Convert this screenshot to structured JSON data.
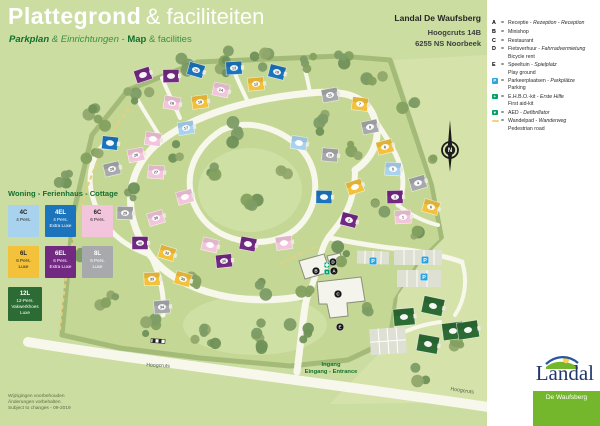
{
  "header": {
    "title_main": "Plattegrond",
    "title_rest": "& faciliteiten",
    "subtitle_segments": [
      {
        "text": "Parkplan ",
        "style": "bold-italic"
      },
      {
        "text": "& Einrichtungen",
        "style": "italic"
      },
      {
        "text": " - ",
        "style": "regular"
      },
      {
        "text": "Map",
        "style": "bold"
      },
      {
        "text": " & facilities",
        "style": "regular"
      }
    ]
  },
  "address": {
    "name": "Landal De Waufsberg",
    "line1": "Hoogcruts 14B",
    "line2": "6255 NS Noorbeek"
  },
  "legend": {
    "items": [
      {
        "icon": "A",
        "icon_type": "letter",
        "eq": "=",
        "main": "Receptie - ",
        "italic": "Rezeption - Reception",
        "sub": ""
      },
      {
        "icon": "B",
        "icon_type": "letter",
        "eq": "=",
        "main": "Minishop",
        "italic": "",
        "sub": ""
      },
      {
        "icon": "C",
        "icon_type": "letter",
        "eq": "=",
        "main": "Restaurant",
        "italic": "",
        "sub": ""
      },
      {
        "icon": "D",
        "icon_type": "letter",
        "eq": "=",
        "main": "Fietsverhuur - ",
        "italic": "Fahrradvermietung",
        "sub": "Bicycle rent"
      },
      {
        "icon": "E",
        "icon_type": "letter",
        "eq": "=",
        "main": "Speeltuin - ",
        "italic": "Spielplatz",
        "sub": "Play ground"
      },
      {
        "icon": "P",
        "icon_type": "parking",
        "eq": "=",
        "main": "Parkeerplaatsen - ",
        "italic": "Parkplätze",
        "sub": "Parking"
      },
      {
        "icon": "+",
        "icon_type": "firstaid",
        "eq": "=",
        "main": "E.H.B.O.-kit - ",
        "italic": "Erste Hilfe",
        "sub": "First aid-kit"
      },
      {
        "icon": "♥",
        "icon_type": "aed",
        "eq": "=",
        "main": "AED - ",
        "italic": "Defibrillator",
        "sub": ""
      },
      {
        "icon": "",
        "icon_type": "dash",
        "eq": "=",
        "main": "Wandelpad - ",
        "italic": "Wanderweg",
        "sub": "Pedestrian road"
      }
    ]
  },
  "cottage_legend": {
    "title": "Woning - Ferienhaus - Cottage",
    "types": [
      {
        "code": "4C",
        "color": "#a9d2ef",
        "text_color": "#222222",
        "lines": [
          "4 Pers."
        ]
      },
      {
        "code": "4EL",
        "color": "#1c75bc",
        "text_color": "#ffffff",
        "lines": [
          "4 Pers.",
          "Extra Luxe"
        ]
      },
      {
        "code": "6C",
        "color": "#f3c5dc",
        "text_color": "#222222",
        "lines": [
          "6 Pers."
        ]
      },
      {
        "code": "6L",
        "color": "#f3c13a",
        "text_color": "#222222",
        "lines": [
          "6 Pers.",
          "Luxe"
        ]
      },
      {
        "code": "6EL",
        "color": "#722982",
        "text_color": "#ffffff",
        "lines": [
          "6 Pers.",
          "Extra Luxe"
        ]
      },
      {
        "code": "8L",
        "color": "#a7a9ac",
        "text_color": "#ffffff",
        "lines": [
          "8 Pers.",
          "Luxe"
        ]
      },
      {
        "code": "12L",
        "color": "#2c6b34",
        "text_color": "#ffffff",
        "lines": [
          "12-Pers.",
          "Vakwerkhoes",
          "Luxe"
        ]
      }
    ]
  },
  "map_labels": {
    "entrance_line1": "Ingang",
    "entrance_line2": "Eingang - Entrance",
    "street_left": "Hoogcruts",
    "street_right": "Hoogcruts",
    "compass": "N"
  },
  "map": {
    "houses": [
      {
        "x": 143,
        "y": 75,
        "type": "6EL",
        "num": ""
      },
      {
        "x": 171,
        "y": 76,
        "type": "6EL",
        "num": ""
      },
      {
        "x": 196,
        "y": 70,
        "type": "4EL",
        "num": "15"
      },
      {
        "x": 234,
        "y": 68,
        "type": "4EL",
        "num": "13"
      },
      {
        "x": 277,
        "y": 72,
        "type": "4EL",
        "num": "19"
      },
      {
        "x": 256,
        "y": 84,
        "type": "6L",
        "num": "12"
      },
      {
        "x": 221,
        "y": 90,
        "type": "6C",
        "num": "14"
      },
      {
        "x": 200,
        "y": 102,
        "type": "6L",
        "num": "18"
      },
      {
        "x": 172,
        "y": 103,
        "type": "6C",
        "num": "16"
      },
      {
        "x": 186,
        "y": 128,
        "type": "4C",
        "num": "17"
      },
      {
        "x": 153,
        "y": 139,
        "type": "6C",
        "num": ""
      },
      {
        "x": 136,
        "y": 155,
        "type": "6C",
        "num": "26"
      },
      {
        "x": 110,
        "y": 143,
        "type": "4EL",
        "num": ""
      },
      {
        "x": 112,
        "y": 169,
        "type": "8L",
        "num": "28"
      },
      {
        "x": 156,
        "y": 172,
        "type": "6C",
        "num": "27"
      },
      {
        "x": 185,
        "y": 197,
        "type": "6C",
        "num": ""
      },
      {
        "x": 125,
        "y": 213,
        "type": "8L",
        "num": "29"
      },
      {
        "x": 156,
        "y": 218,
        "type": "6C",
        "num": "30"
      },
      {
        "x": 140,
        "y": 243,
        "type": "6EL",
        "num": "40"
      },
      {
        "x": 167,
        "y": 253,
        "type": "6L",
        "num": "32"
      },
      {
        "x": 152,
        "y": 279,
        "type": "6L",
        "num": "33"
      },
      {
        "x": 183,
        "y": 279,
        "type": "6L",
        "num": "35"
      },
      {
        "x": 162,
        "y": 307,
        "type": "8L",
        "num": "34"
      },
      {
        "x": 210,
        "y": 245,
        "type": "6C",
        "num": ""
      },
      {
        "x": 224,
        "y": 261,
        "type": "6EL",
        "num": "36"
      },
      {
        "x": 248,
        "y": 244,
        "type": "6EL",
        "num": ""
      },
      {
        "x": 284,
        "y": 243,
        "type": "6C",
        "num": ""
      },
      {
        "x": 299,
        "y": 143,
        "type": "4C",
        "num": ""
      },
      {
        "x": 330,
        "y": 95,
        "type": "8L",
        "num": "11"
      },
      {
        "x": 360,
        "y": 104,
        "type": "6L",
        "num": "7"
      },
      {
        "x": 370,
        "y": 127,
        "type": "8L",
        "num": "9"
      },
      {
        "x": 330,
        "y": 155,
        "type": "8L",
        "num": "10"
      },
      {
        "x": 385,
        "y": 147,
        "type": "6L",
        "num": "8"
      },
      {
        "x": 393,
        "y": 169,
        "type": "4C",
        "num": "5"
      },
      {
        "x": 418,
        "y": 183,
        "type": "8L",
        "num": "4"
      },
      {
        "x": 324,
        "y": 197,
        "type": "4EL",
        "num": ""
      },
      {
        "x": 355,
        "y": 187,
        "type": "6L",
        "num": ""
      },
      {
        "x": 395,
        "y": 197,
        "type": "6EL",
        "num": "3"
      },
      {
        "x": 431,
        "y": 207,
        "type": "6L",
        "num": "6"
      },
      {
        "x": 403,
        "y": 217,
        "type": "6C",
        "num": "1"
      },
      {
        "x": 349,
        "y": 220,
        "type": "6EL",
        "num": "2"
      },
      {
        "x": 404,
        "y": 317,
        "type": "12L",
        "num": ""
      },
      {
        "x": 433,
        "y": 306,
        "type": "12L",
        "num": ""
      },
      {
        "x": 453,
        "y": 331,
        "type": "12L",
        "num": ""
      },
      {
        "x": 428,
        "y": 344,
        "type": "12L",
        "num": ""
      },
      {
        "x": 468,
        "y": 330,
        "type": "12L",
        "num": ""
      }
    ],
    "facility_markers": [
      {
        "x": 333,
        "y": 262,
        "label": "D"
      },
      {
        "x": 316,
        "y": 271,
        "label": "B"
      },
      {
        "x": 334,
        "y": 271,
        "label": "A"
      },
      {
        "x": 338,
        "y": 294,
        "label": "C"
      },
      {
        "x": 340,
        "y": 327,
        "label": "E"
      }
    ],
    "parking_markers": [
      {
        "x": 373,
        "y": 261,
        "label": "P"
      },
      {
        "x": 425,
        "y": 260,
        "label": "P"
      },
      {
        "x": 424,
        "y": 277,
        "label": "P"
      }
    ],
    "aid_markers": [
      {
        "x": 327,
        "y": 265,
        "kind": "firstaid"
      },
      {
        "x": 327,
        "y": 272,
        "kind": "aed"
      }
    ]
  },
  "footer": {
    "lines": [
      "Wijzigingen voorbehouden",
      "Änderungen vorbehalten",
      "Subject to changes - 09-2019"
    ]
  },
  "logo": {
    "brand": "Landal",
    "park": "De Waufsberg"
  },
  "colors": {
    "page_bg": "#cbdda0",
    "panel_bg": "#ffffff",
    "park_green": "#c4d795",
    "lawn_green": "#d5e3ab",
    "road": "#f7f7ec",
    "accent_green": "#15722e",
    "parking_blue": "#2ba3dc",
    "aid_green": "#00a263",
    "logo_green": "#74b62c",
    "logo_blue": "#21386b",
    "path_yellow": "#e6cf7f"
  }
}
